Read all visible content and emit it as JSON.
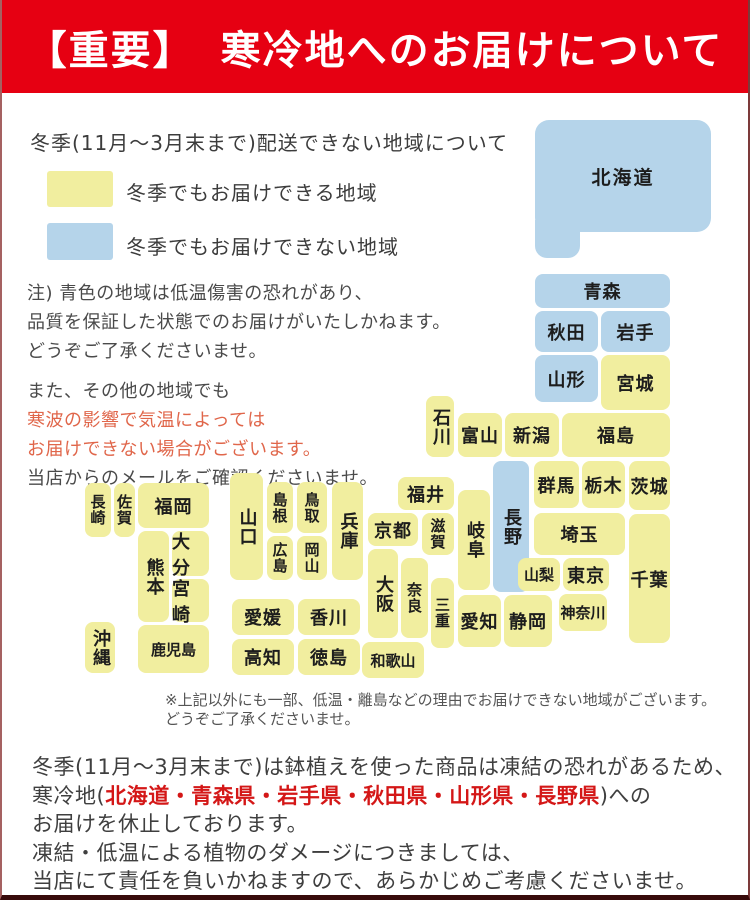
{
  "header": {
    "badge": "【重要】",
    "title": "寒冷地へのお届けについて"
  },
  "legend": {
    "heading": "冬季(11月〜3月末まで)配送できない地域について",
    "ok_label": "冬季でもお届けできる地域",
    "ng_label": "冬季でもお届けできない地域"
  },
  "colors": {
    "banner": "#e60012",
    "deliverable": "#f1ee9f",
    "not_deliverable": "#b5d4ea",
    "warn_text": "#e0664a",
    "footer_red": "#d41717"
  },
  "notes": {
    "para1_line1": "注) 青色の地域は低温傷害の恐れがあり、",
    "para1_line2": "品質を保証した状態でのお届けがいたしかねます。",
    "para1_line3": "どうぞご了承くださいませ。",
    "para2_line1": "また、その他の地域でも",
    "para2_red1": "寒波の影響で気温によっては",
    "para2_red2": "お届けできない場合がございます。",
    "para2_line4": "当店からのメールをご確認くださいませ。"
  },
  "map": {
    "footnote_line1": "※上記以外にも一部、低温・離島などの理由でお届けできない地域がございます。",
    "footnote_line2": "どうぞご了承くださいませ。",
    "prefectures": [
      {
        "id": "hokkaido",
        "label": "北海道",
        "deliverable": false
      },
      {
        "id": "aomori",
        "label": "青森",
        "deliverable": false
      },
      {
        "id": "akita",
        "label": "秋田",
        "deliverable": false
      },
      {
        "id": "iwate",
        "label": "岩手",
        "deliverable": false
      },
      {
        "id": "yamagata",
        "label": "山形",
        "deliverable": false
      },
      {
        "id": "miyagi",
        "label": "宮城",
        "deliverable": true
      },
      {
        "id": "fukushima",
        "label": "福島",
        "deliverable": true
      },
      {
        "id": "niigata",
        "label": "新潟",
        "deliverable": true
      },
      {
        "id": "toyama",
        "label": "富山",
        "deliverable": true
      },
      {
        "id": "ishikawa",
        "label": "石川",
        "deliverable": true
      },
      {
        "id": "nagano",
        "label": "長野",
        "deliverable": false
      },
      {
        "id": "gifu",
        "label": "岐阜",
        "deliverable": true
      },
      {
        "id": "gunma",
        "label": "群馬",
        "deliverable": true
      },
      {
        "id": "tochigi",
        "label": "栃木",
        "deliverable": true
      },
      {
        "id": "ibaraki",
        "label": "茨城",
        "deliverable": true
      },
      {
        "id": "saitama",
        "label": "埼玉",
        "deliverable": true
      },
      {
        "id": "chiba",
        "label": "千葉",
        "deliverable": true
      },
      {
        "id": "yamanashi",
        "label": "山梨",
        "deliverable": true
      },
      {
        "id": "tokyo",
        "label": "東京",
        "deliverable": true
      },
      {
        "id": "kanagawa",
        "label": "神奈川",
        "deliverable": true
      },
      {
        "id": "shizuoka",
        "label": "静岡",
        "deliverable": true
      },
      {
        "id": "aichi",
        "label": "愛知",
        "deliverable": true
      },
      {
        "id": "fukui",
        "label": "福井",
        "deliverable": true
      },
      {
        "id": "shiga",
        "label": "滋賀",
        "deliverable": true
      },
      {
        "id": "kyoto",
        "label": "京都",
        "deliverable": true
      },
      {
        "id": "osaka",
        "label": "大阪",
        "deliverable": true
      },
      {
        "id": "nara",
        "label": "奈良",
        "deliverable": true
      },
      {
        "id": "mie",
        "label": "三重",
        "deliverable": true
      },
      {
        "id": "wakayama",
        "label": "和歌山",
        "deliverable": true
      },
      {
        "id": "hyogo",
        "label": "兵庫",
        "deliverable": true
      },
      {
        "id": "tottori",
        "label": "鳥取",
        "deliverable": true
      },
      {
        "id": "shimane",
        "label": "島根",
        "deliverable": true
      },
      {
        "id": "okayama",
        "label": "岡山",
        "deliverable": true
      },
      {
        "id": "hiroshima",
        "label": "広島",
        "deliverable": true
      },
      {
        "id": "yamaguchi",
        "label": "山口",
        "deliverable": true
      },
      {
        "id": "kagawa",
        "label": "香川",
        "deliverable": true
      },
      {
        "id": "tokushima",
        "label": "徳島",
        "deliverable": true
      },
      {
        "id": "ehime",
        "label": "愛媛",
        "deliverable": true
      },
      {
        "id": "kochi",
        "label": "高知",
        "deliverable": true
      },
      {
        "id": "fukuoka",
        "label": "福岡",
        "deliverable": true
      },
      {
        "id": "saga",
        "label": "佐賀",
        "deliverable": true
      },
      {
        "id": "nagasaki",
        "label": "長崎",
        "deliverable": true
      },
      {
        "id": "oita",
        "label": "大分",
        "deliverable": true
      },
      {
        "id": "miyazaki",
        "label": "宮崎",
        "deliverable": true
      },
      {
        "id": "kumamoto",
        "label": "熊本",
        "deliverable": true
      },
      {
        "id": "kagoshima",
        "label": "鹿児島",
        "deliverable": true
      },
      {
        "id": "okinawa",
        "label": "沖縄",
        "deliverable": true
      }
    ]
  },
  "footer": {
    "line1": "冬季(11月〜3月末まで)は鉢植えを使った商品は凍結の恐れがあるため、",
    "line2_prefix": "寒冷地(",
    "line2_red": "北海道・青森県・岩手県・秋田県・山形県・長野県",
    "line2_suffix": ")への",
    "line3": "お届けを休止しております。",
    "line4": "凍結・低温による植物のダメージにつきましては、",
    "line5": "当店にて責任を負いかねますので、あらかじめご考慮くださいませ。"
  }
}
